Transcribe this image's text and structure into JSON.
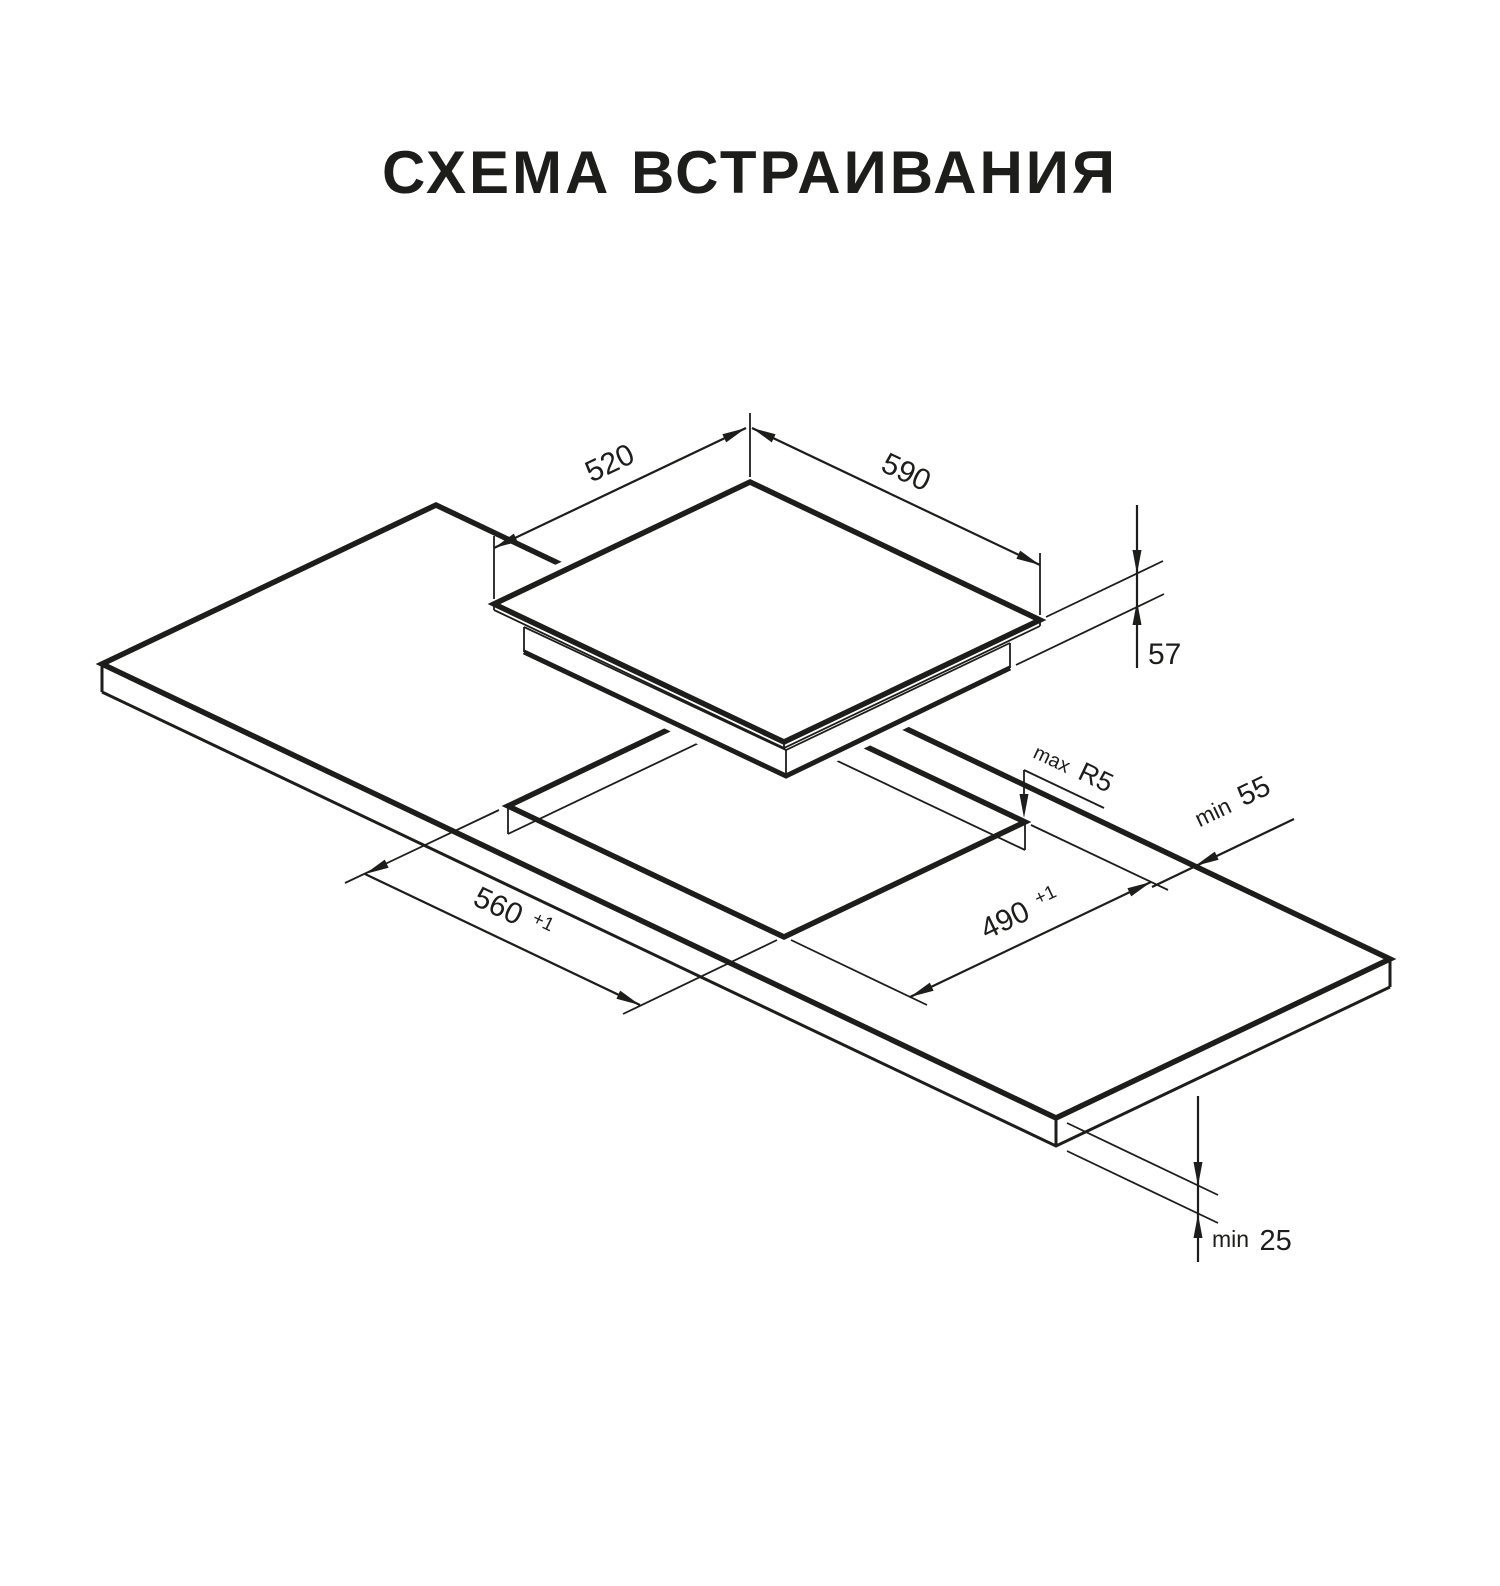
{
  "title": "СХЕМА ВСТРАИВАНИЯ",
  "diagram": {
    "colors": {
      "line": "#1d1d1b",
      "background": "#ffffff"
    },
    "cooktop": {
      "width_label": "590",
      "depth_label": "520",
      "height_label": "57"
    },
    "cutout": {
      "width_label": "560",
      "width_tolerance": "+1",
      "depth_label": "490",
      "depth_tolerance": "+1",
      "corner_radius_prefix": "max",
      "corner_radius_label": "R5"
    },
    "countertop": {
      "rear_clearance_prefix": "min",
      "rear_clearance_label": "55",
      "thickness_prefix": "min",
      "thickness_label": "25"
    }
  }
}
